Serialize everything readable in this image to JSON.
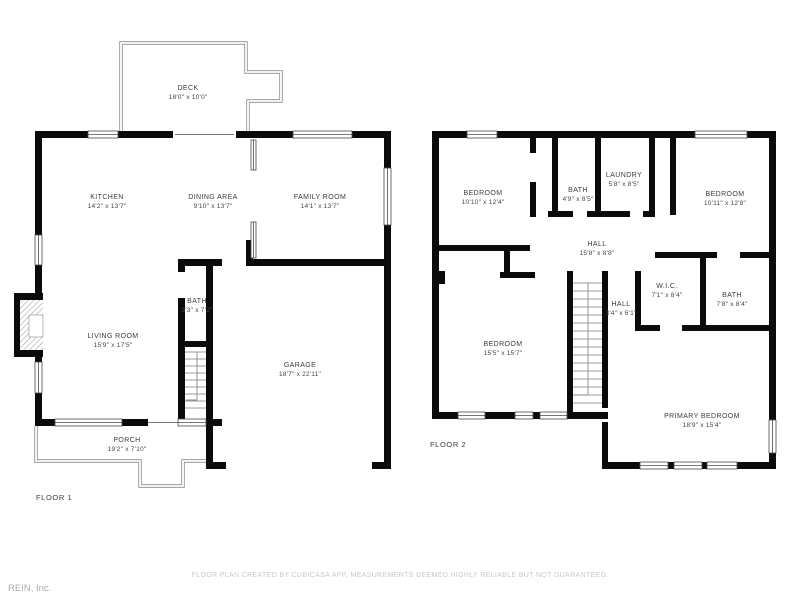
{
  "floor1": {
    "label": "FLOOR 1",
    "rooms": {
      "deck": {
        "name": "DECK",
        "dims": "18'0\" x 10'0\""
      },
      "kitchen": {
        "name": "KITCHEN",
        "dims": "14'2\" x 13'7\""
      },
      "dining": {
        "name": "DINING AREA",
        "dims": "9'10\" x 13'7\""
      },
      "family": {
        "name": "FAMILY ROOM",
        "dims": "14'1\" x 13'7\""
      },
      "bath": {
        "name": "BATH",
        "dims": "3'3\" x 7'2\""
      },
      "living": {
        "name": "LIVING ROOM",
        "dims": "15'9\" x 17'5\""
      },
      "garage": {
        "name": "GARAGE",
        "dims": "18'7\" x 22'11\""
      },
      "porch": {
        "name": "PORCH",
        "dims": "19'2\" x 7'10\""
      }
    }
  },
  "floor2": {
    "label": "FLOOR 2",
    "rooms": {
      "bedroom1": {
        "name": "BEDROOM",
        "dims": "10'10\" x 12'4\""
      },
      "bath1": {
        "name": "BATH",
        "dims": "4'9\" x 8'5\""
      },
      "laundry": {
        "name": "LAUNDRY",
        "dims": "5'8\" x 8'5\""
      },
      "bedroom2": {
        "name": "BEDROOM",
        "dims": "10'11\" x 12'8\""
      },
      "hall1": {
        "name": "HALL",
        "dims": "15'8\" x 8'8\""
      },
      "bedroom3": {
        "name": "BEDROOM",
        "dims": "15'5\" x 15'7\""
      },
      "hall2": {
        "name": "HALL",
        "dims": "3'4\" x 6'1\""
      },
      "wic": {
        "name": "W.I.C.",
        "dims": "7'1\" x 8'4\""
      },
      "bath2": {
        "name": "BATH",
        "dims": "7'8\" x 8'4\""
      },
      "primary": {
        "name": "PRIMARY BEDROOM",
        "dims": "18'9\" x 15'4\""
      }
    }
  },
  "footer": {
    "disclaimer": "FLOOR PLAN CREATED BY CUBICASA APP. MEASUREMENTS DEEMED HIGHLY RELIABLE BUT NOT GUARANTEED.",
    "brand": "REIN, Inc."
  }
}
